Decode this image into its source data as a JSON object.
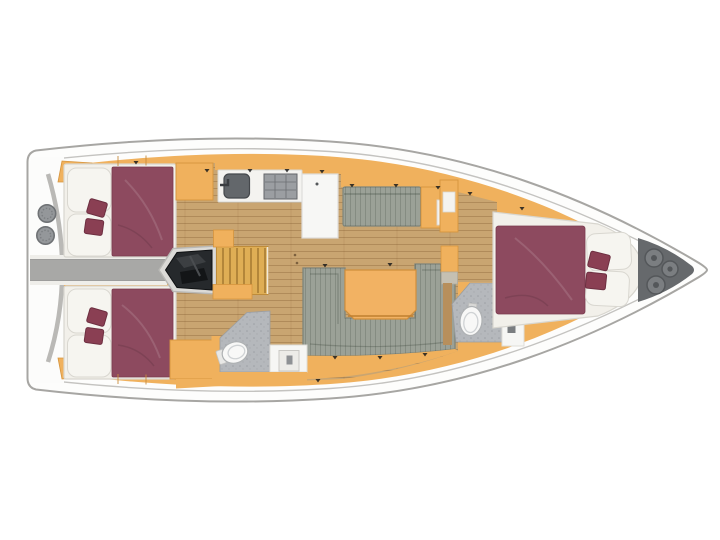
{
  "plan": {
    "type": "yacht-interior-floor-plan",
    "view": "top-down",
    "bow_direction": "right",
    "rooms": [
      "aft-port-cabin",
      "aft-starboard-cabin",
      "aft-head",
      "engine-compartment",
      "companionway",
      "galley",
      "salon",
      "forward-head",
      "forward-cabin",
      "anchor-locker",
      "stern-cockpit"
    ],
    "fixtures": [
      "double-berth",
      "pillows",
      "accent-cushions",
      "wardrobe",
      "corridor",
      "engine",
      "stairs",
      "sink",
      "stove",
      "fridge-counter",
      "settee-bench",
      "u-shaped-sofa",
      "saloon-table",
      "toilet",
      "vanity-sink",
      "shower-floor",
      "helm-circles",
      "transom-arc",
      "rope-coils"
    ]
  },
  "colors": {
    "hull_fill": "#fdfdfc",
    "hull_line": "#a7a6a3",
    "deck_line": "#c4c3c0",
    "cabinetry": "#f0b15d",
    "cabinetry_edge": "#d6953e",
    "wood_floor": "#c9a571",
    "wood_wall": "#b78f5c",
    "bed_platform": "#f2f0ea",
    "bed_platform_edge": "#d8d6cf",
    "duvet": "#8d4a5f",
    "duvet_edge": "#7a3a4e",
    "pillow": "#f6f5f0",
    "pillow_edge": "#d9d7d0",
    "cushion": "#8a3f53",
    "cushion_edge": "#6d2f41",
    "corridor_floor": "#a8a8a6",
    "corridor_border": "#efeeea",
    "engine": "#26292c",
    "engine_frame": "#dbdad7",
    "stairs": "#dfae55",
    "stair_tread": "#a87c33",
    "counter": "#f4f3f0",
    "counter_edge": "#d9d8d4",
    "sink": "#63676b",
    "sink_edge": "#45484c",
    "stove": "#9b9ea2",
    "stove_grid": "#63666a",
    "fridge": "#f7f7f5",
    "fridge_edge": "#deddda",
    "settee": "#9ba197",
    "settee_edge": "#7e857b",
    "table": "#f2b263",
    "table_edge": "#d08f3c",
    "bath_floor": "#b5b8bc",
    "bath_floor_edge": "#9a9da1",
    "toilet": "#f8f8f7",
    "toilet_edge": "#aeb1b3",
    "vanity": "#f6f6f4",
    "vanity_edge": "#deddd9",
    "vanity_slot": "#7a7d80",
    "anchor_locker": "#66696c",
    "rope": "#7b7e81",
    "rope_edge": "#54575a",
    "helm_circle": "#94979a",
    "helm_circle_edge": "#6f7275",
    "arc_line": "#b6b5b2",
    "stern_white": "#fcfcfb",
    "step": "#c5c0b2",
    "tick": "#1c1c1c"
  }
}
